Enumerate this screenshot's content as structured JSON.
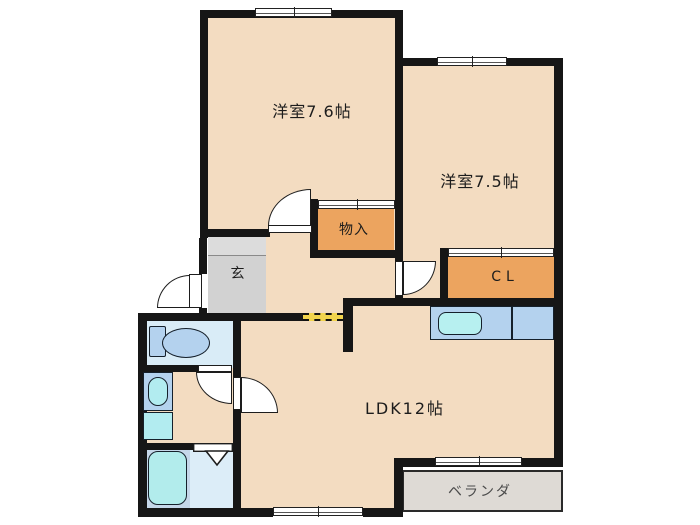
{
  "floorplan": {
    "labels": {
      "room_west": "洋室7.6帖",
      "room_east": "洋室7.5帖",
      "storage": "物入",
      "entrance": "玄",
      "closet": "CL",
      "ldk": "LDK12帖",
      "veranda": "ベランダ"
    },
    "colors": {
      "floor": "#f3dcc1",
      "storage_fill": "#eca45f",
      "entrance_upper": "#dcdcdc",
      "entrance_lower": "#d2d2d2",
      "wet_floor": "#d9ecf7",
      "bath_left": "#c5d7e9",
      "bath_right": "#dcedf8",
      "fixture_blue": "#b4d2ee",
      "fixture_cyan": "#b2ecf0",
      "veranda_fill": "#dedad5",
      "wall": "#161616",
      "opening_dash": "#f2d44d"
    }
  }
}
